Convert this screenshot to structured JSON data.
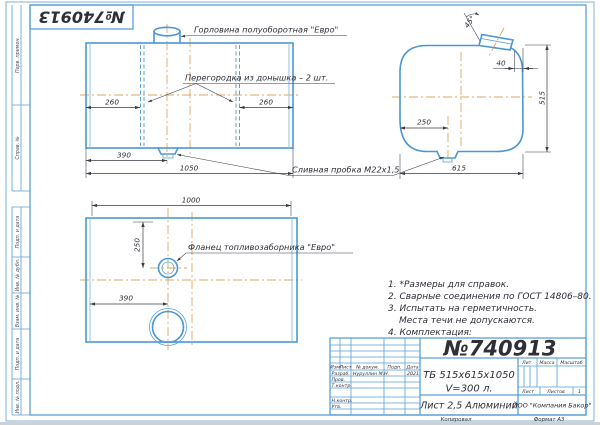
{
  "colors": {
    "line_blue": "#4a97d4",
    "centerline_tan": "#dca766",
    "ink": "#2e2f38",
    "paper": "#ffffff"
  },
  "corner_stamp": "№740913",
  "margin": {
    "top_labels": [
      "Перв. примен.",
      "Справ. №"
    ],
    "bottom_labels": [
      "Подп. и дата",
      "Инв. № дубл.",
      "Взам. инв. №",
      "Подп. и дата",
      "Инв. № подл."
    ]
  },
  "callouts": {
    "neck": "Горловина полуоборотная \"Евро\"",
    "partition": "Перегородка из донышка – 2 шт.",
    "drain_plug": "Сливная пробка М22х1,5",
    "flange": "Фланец топливозаборника \"Евро\""
  },
  "dims": {
    "front": {
      "left_260": "260",
      "right_260": "260",
      "d390": "390",
      "d1050": "1050"
    },
    "side": {
      "angle": "45°",
      "d40": "40",
      "d515": "515",
      "d250": "250",
      "d615": "615"
    },
    "bottom": {
      "d1000": "1000",
      "d250": "250",
      "d390": "390"
    }
  },
  "notes": {
    "n1": "1. *Размеры для справок.",
    "n2": "2. Сварные соединения по ГОСТ 14806–80.",
    "n3": "3. Испытать на герметичность.",
    "n3b": "Места течи не допускаются.",
    "n4": "4. Комплектация:"
  },
  "title_block": {
    "doc_number": "№740913",
    "designation": "ТБ 515х615х1050",
    "volume": "V=300 л.",
    "material": "Лист 2,5 Алюминий",
    "company": "ООО \"Компания Бакор\"",
    "header": {
      "izm": "Изм",
      "list": "Лист",
      "doc": "№ докум.",
      "podp": "Подп.",
      "data": "Дата"
    },
    "rows": {
      "razrab": "Разраб.",
      "prov": "Пров.",
      "tkontr": "Т.контр.",
      "nkontr": "Н.контр.",
      "utv": "Утв."
    },
    "razrab_name": "Нуруллин М.Н.",
    "razrab_date": "2021",
    "lit": "Лит.",
    "massa": "Масса",
    "masshtab": "Масштаб",
    "list_label": "Лист",
    "listov_label": "Листов",
    "listov_value": "1",
    "copied": "Копировал",
    "format": "Формат   А3"
  }
}
